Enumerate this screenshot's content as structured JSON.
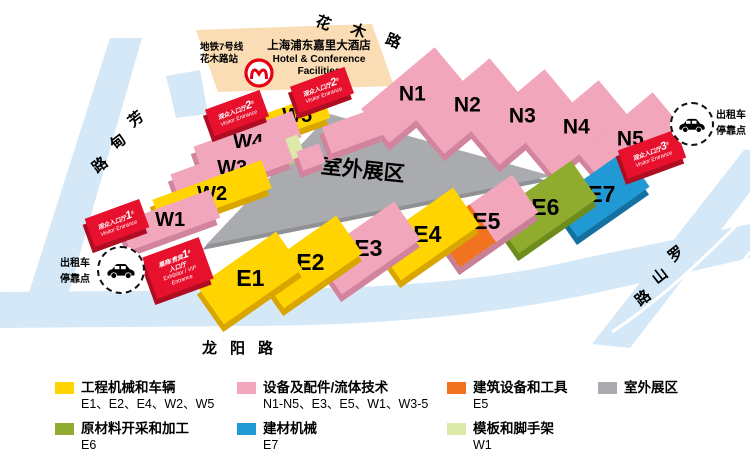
{
  "roads": {
    "top": {
      "name": "花木路",
      "chars": [
        "花",
        "木",
        "路"
      ]
    },
    "left": {
      "name": "芳甸路",
      "chars": [
        "芳",
        "甸",
        "路"
      ]
    },
    "right": {
      "name": "罗山路",
      "chars": [
        "罗",
        "山",
        "路"
      ]
    },
    "bottom": {
      "name": "龙阳路"
    }
  },
  "metro": {
    "line1": "地铁7号线",
    "line2": "花木路站"
  },
  "hotel": {
    "name_cn": "上海浦东嘉里大酒店",
    "name_en1": "Hotel & Conference",
    "name_en2": "Facilities"
  },
  "outdoor": {
    "label": "室外展区"
  },
  "halls": {
    "n": [
      "N1",
      "N2",
      "N3",
      "N4",
      "N5"
    ],
    "w": [
      "W1",
      "W2",
      "W3",
      "W4",
      "W5"
    ],
    "e": [
      "E1",
      "E2",
      "E3",
      "E4",
      "E5",
      "E6",
      "E7"
    ]
  },
  "entrances": {
    "visitor1": {
      "cn": "观众入口厅",
      "num": "1",
      "sup": "#",
      "en": "Visitor Entrance"
    },
    "visitor2a": {
      "cn": "观众入口厅",
      "num": "2",
      "sup": "#",
      "en": "Visitor Entrance"
    },
    "visitor2b": {
      "cn": "观众入口厅",
      "num": "2",
      "sup": "#",
      "en": "Visitor Entrance"
    },
    "visitor3": {
      "cn": "观众入口厅",
      "num": "3",
      "sup": "#",
      "en": "Visitor Entrance"
    },
    "vip": {
      "cn1": "展商/贵宾",
      "num": "1",
      "sup": "#",
      "cn2": "入口厅",
      "en1": "Exhibitor / VIP",
      "en2": "Entrance"
    }
  },
  "taxi": {
    "line1": "出租车",
    "line2": "停靠点"
  },
  "legend": [
    {
      "color": "#ffd400",
      "title": "工程机械和车辆",
      "halls": "E1、E2、E4、W2、W5"
    },
    {
      "color": "#f2a6bc",
      "title": "设备及配件/流体技术",
      "halls": "N1-N5、E3、E5、W1、W3-5"
    },
    {
      "color": "#f1731f",
      "title": "建筑设备和工具",
      "halls": "E5"
    },
    {
      "color": "#a9abae",
      "title": "室外展区",
      "halls": ""
    },
    {
      "color": "#8fac2f",
      "title": "原材料开采和加工",
      "halls": "E6"
    },
    {
      "color": "#2199d5",
      "title": "建材机械",
      "halls": "E7"
    },
    {
      "color": "#dce9a8",
      "title": "模板和脚手架",
      "halls": "W1"
    }
  ],
  "colors": {
    "pink": "#f2a6bc",
    "yellow": "#ffd400",
    "red": "#e8112d",
    "orange": "#f1731f",
    "olive": "#8fac2f",
    "blue": "#2199d5",
    "lightgreen": "#dce9a8",
    "gray": "#a9abae",
    "hotel": "#fbddb5",
    "road": "#d4e8f7"
  }
}
